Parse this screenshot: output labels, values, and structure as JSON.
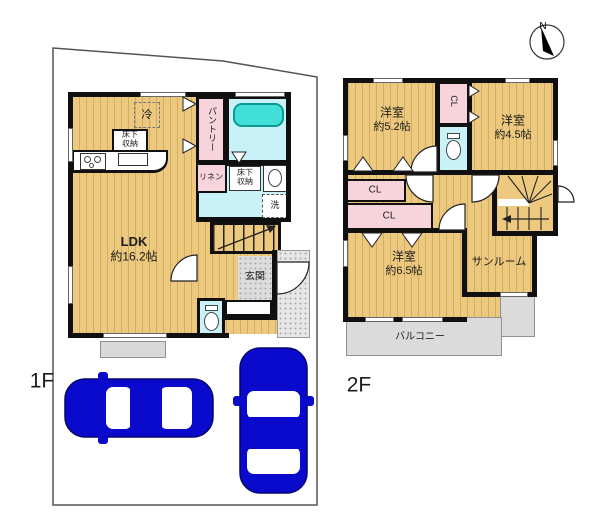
{
  "compass": {
    "north": "N"
  },
  "floor1": {
    "label": "1F",
    "ldk": {
      "name": "LDK",
      "size": "約16.2帖"
    },
    "pantry": "パントリー",
    "linen": "リネン",
    "laundry": "洗",
    "fridge": "冷",
    "underfloor_storage_1": "床下収納",
    "underfloor_storage_2": "床下収納",
    "entrance": "玄関"
  },
  "floor2": {
    "label": "2F",
    "room_52": {
      "name": "洋室",
      "size": "約5.2帖"
    },
    "room_45": {
      "name": "洋室",
      "size": "約4.5帖"
    },
    "room_65": {
      "name": "洋室",
      "size": "約6.5帖"
    },
    "closet_top": "CL",
    "closet_a": "CL",
    "closet_b": "CL",
    "sunroom": "サンルーム",
    "balcony": "バルコニー"
  },
  "colors": {
    "floor_tan": "#ECC97E",
    "closet_pink": "#F7D3DB",
    "wet_area_cyan": "#C9F2F8",
    "bathtub_teal": "#42DED8",
    "tile_gray": "#DCDCDC",
    "car_blue": "#0A0ACC",
    "wall_black": "#101010"
  }
}
